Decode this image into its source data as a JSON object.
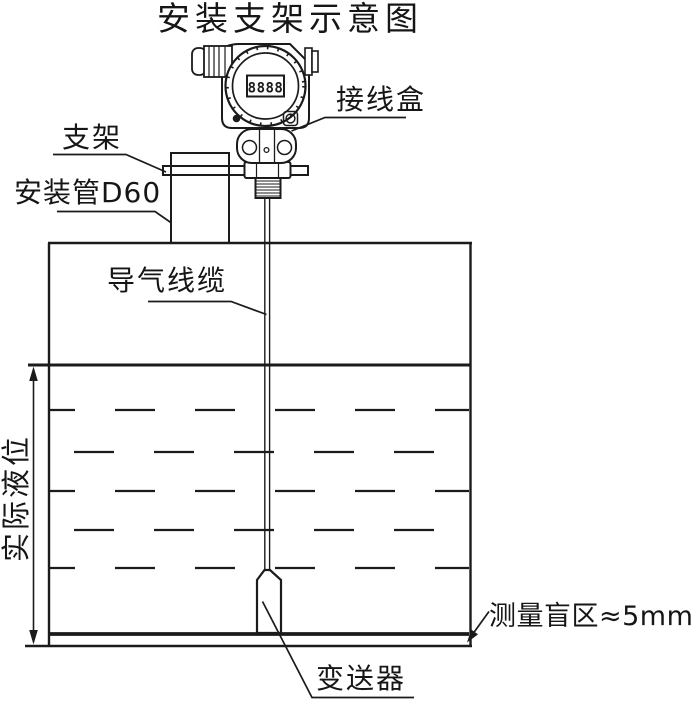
{
  "title": "安装支架示意图",
  "lcd": {
    "value": "8888"
  },
  "labels": {
    "bracket": "支架",
    "mounting_pipe": "安装管D60",
    "junction_box": "接线盒",
    "air_cable": "导气线缆",
    "actual_level": "实际液位",
    "blind_zone": "测量盲区≈5mm",
    "transmitter": "变送器"
  },
  "colors": {
    "line": "#1b1b1b",
    "background": "#ffffff"
  }
}
